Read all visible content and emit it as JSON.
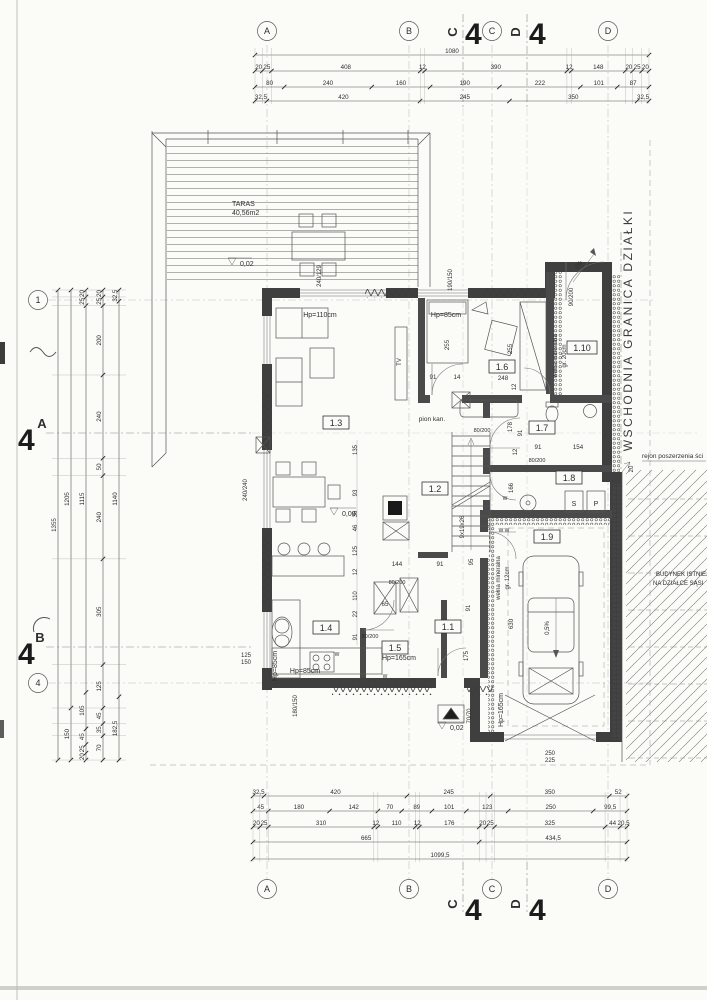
{
  "drawing": {
    "terrace": {
      "name": "TARAS",
      "area": "40,56m2",
      "deck_level": "0,02"
    },
    "levels": {
      "zero": "0,00",
      "entry": "0,02"
    },
    "rooms": {
      "r11": "1.1",
      "r12": "1.2",
      "r13": "1.3",
      "r14": "1.4",
      "r15": "1.5",
      "r16": "1.6",
      "r17": "1.7",
      "r18": "1.8",
      "r19": "1.9",
      "r110": "1.10"
    },
    "labels": {
      "hp110": "Hp=110cm",
      "hp85": "Hp=85cm",
      "hp165": "Hp=165cm",
      "tv": "TV",
      "pion_kan": "pion kan.",
      "welna": "wełna mineralna",
      "gr20": "gr. 20cm",
      "gr12": "gr. 12cm",
      "stairs": "9x19x26",
      "slope_garage": "0,5%",
      "slope_entry": "2%",
      "dryer": "S",
      "washer": "P",
      "w_mark": "W",
      "ww_mark": "W W",
      "d255": "255",
      "d248": "248",
      "d12": "12",
      "d91": "91",
      "d14": "14",
      "d178": "178",
      "d154": "154",
      "d166": "166",
      "d630": "630",
      "d144": "144",
      "d65": "65",
      "d95": "95",
      "d135": "135",
      "d93": "93",
      "d36": "36",
      "d46": "46",
      "d125": "125",
      "d110": "110",
      "d22": "22",
      "d175": "175",
      "d20": "20",
      "d70_70": "70/70",
      "win240_129": "240/129",
      "win240_240": "240/240",
      "win190_150": "190/150",
      "win125": "125",
      "win150": "150",
      "win180_150": "180/150",
      "door90_200": "90/200",
      "door80_200": "80/200",
      "garage250": "250",
      "garage225": "225"
    },
    "site": {
      "east_boundary": "WSCHODNIA GRANICA DZIAŁKI",
      "widening": "rejon poszerzenia ści",
      "neighbor1": "BUDYNEK ISTNIEJĄ",
      "neighbor2": "NA DZIAŁCE SĄSI"
    },
    "grid": {
      "a": "A",
      "b": "B",
      "c": "C",
      "d": "D",
      "r1": "1",
      "r4": "4",
      "sheet": "4"
    },
    "dims": {
      "top": {
        "total": [
          "1080"
        ],
        "row2": [
          "20",
          "25",
          "408",
          "12",
          "390",
          "12",
          "148",
          "20",
          "25",
          "20"
        ],
        "row3": [
          "80",
          "240",
          "160",
          "190",
          "222",
          "101",
          "87"
        ],
        "row4": [
          "32,5",
          "420",
          "245",
          "350",
          "32,5"
        ]
      },
      "bottom": {
        "row1": [
          "32,5",
          "420",
          "245",
          "350",
          "52"
        ],
        "row2": [
          "45",
          "180",
          "142",
          "70",
          "89",
          "101",
          "123",
          "250",
          "99,5"
        ],
        "row3": [
          "20",
          "25",
          "310",
          "12",
          "110",
          "12",
          "176",
          "20",
          "25",
          "325",
          "44",
          "20,5"
        ],
        "row4": [
          "665",
          "434,5"
        ],
        "total": [
          "1099,5"
        ]
      },
      "left": {
        "col1": [
          "1355"
        ],
        "col2": [
          "1205",
          "150"
        ],
        "col3": [
          "20",
          "25",
          "1115",
          "105",
          "45",
          "25",
          "20"
        ],
        "col4": [
          "20",
          "25",
          "200",
          "240",
          "50",
          "240",
          "305",
          "125",
          "45",
          "35",
          "70"
        ],
        "col5": [
          "32,5",
          "1140",
          "182,5"
        ]
      }
    }
  }
}
